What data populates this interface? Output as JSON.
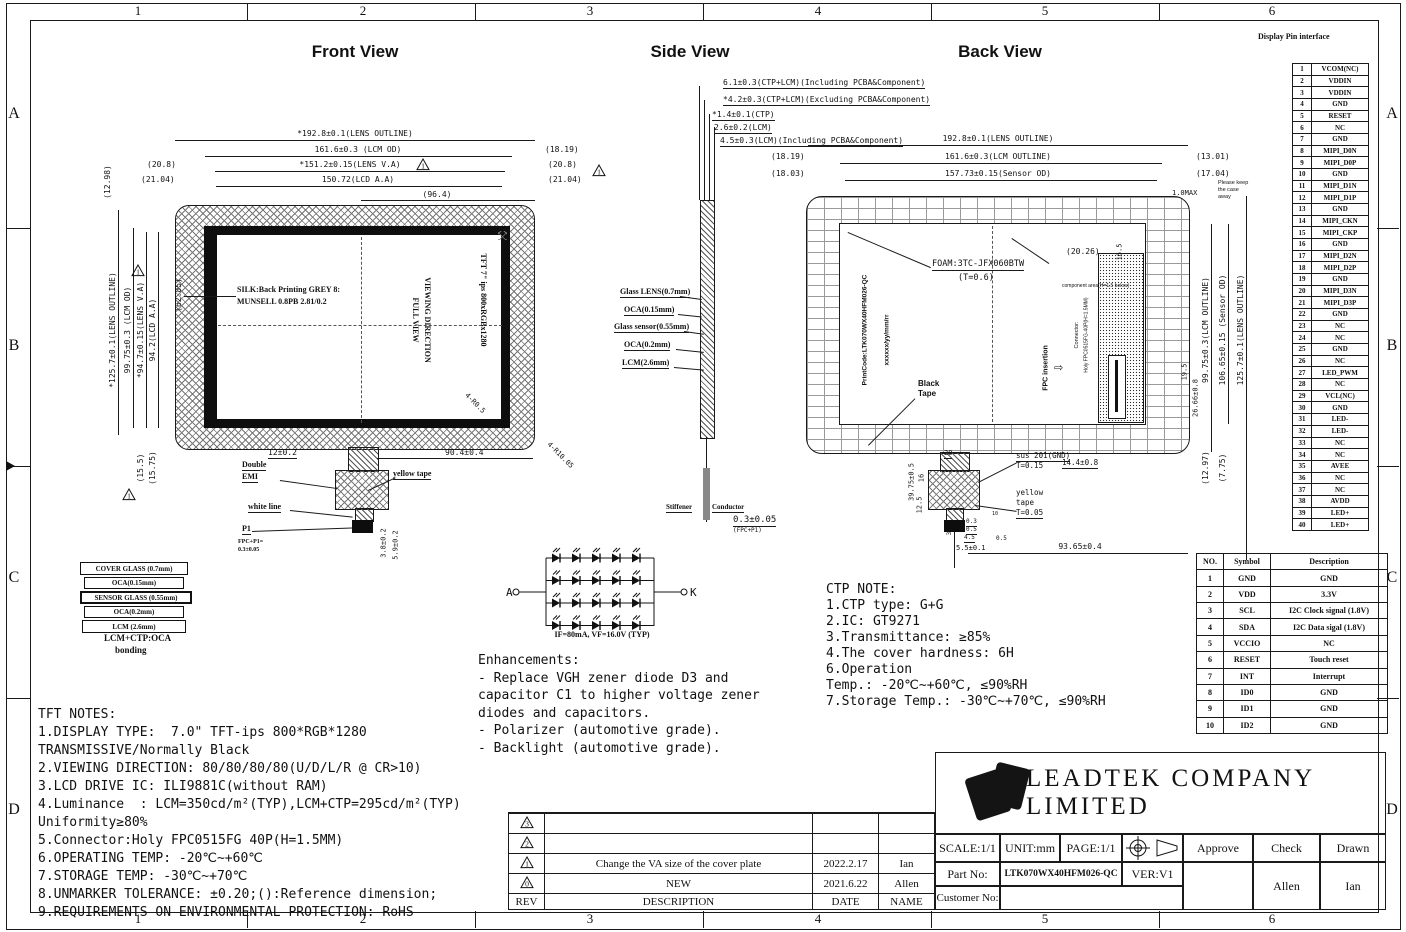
{
  "sheet": {
    "cols": [
      "1",
      "2",
      "3",
      "4",
      "5",
      "6"
    ],
    "rows": [
      "A",
      "B",
      "C",
      "D"
    ]
  },
  "front_view": {
    "title": "Front View",
    "dim_lens_outline_h": "*192.8±0.1(LENS OUTLINE)",
    "dim_lcm_od_h": "161.6±0.3 (LCM OD)",
    "dim_lens_va_h": "*151.2±0.15(LENS V.A)",
    "dim_lcd_aa_h": "150.72(LCD A.A)",
    "dim_96_4": "(96.4)",
    "dim_18_19_r": "(18.19)",
    "dim_20_8_l": "(20.8)",
    "dim_20_8_r": "(20.8)",
    "dim_21_04_l": "(21.04)",
    "dim_21_04_r": "(21.04)",
    "dim_12_98": "(12.98)",
    "dim_lens_outline_v": "*125.7±0.1(LENS OUTLINE)",
    "dim_lcm_od_v": "99.75±0.3 (LCM OD)",
    "dim_lens_va_v": "*94.7±0.15(LENS V.A)",
    "dim_lcd_aa_v": "94.2(LCD A.A)",
    "dim_62_85": "(62.85)",
    "dim_15_5": "(15.5)",
    "dim_15_75": "(15.75)",
    "silk_line1": "SILK:Back Printing GREY 8:",
    "silk_line2": "MUNSELL 0.8PB 2.81/0.2",
    "viewing_direction_1": "VIEWING DIRECTION",
    "viewing_direction_2": "FULL VIEW",
    "panel_label": "TFT 7\" ips 800xRGBx1280",
    "corner_r_inner": "4-R0.5",
    "corner_r_outer": "4-R10.05",
    "dim_12": "12±0.2",
    "dim_90_4": "90.4±0.4",
    "lbl_double": "Double",
    "lbl_emi": "EMI",
    "lbl_yellow_tape": "yellow tape",
    "lbl_white_line": "white line",
    "lbl_p1": "P1",
    "lbl_fpc_p1a": "FPC+P1=",
    "lbl_fpc_p1b": "0.3±0.05",
    "dim_3_8": "3.8±0.2",
    "dim_5_9": "5.9±0.2"
  },
  "stack": {
    "layers": [
      "COVER GLASS (0.7mm)",
      "OCA(0.15mm)",
      "SENSOR GLASS (0.55mm)",
      "OCA(0.2mm)",
      "LCM (2.6mm)"
    ],
    "caption1": "LCM+CTP:OCA",
    "caption2": "bonding"
  },
  "side_view": {
    "title": "Side View",
    "top_dims": [
      "6.1±0.3(CTP+LCM)(Including PCBA&Component)",
      "*4.2±0.3(CTP+LCM)(Excluding PCBA&Component)",
      "*1.4±0.1(CTP)",
      "2.6±0.2(LCM)",
      "4.5±0.3(LCM)(Including PCBA&Component)"
    ],
    "layer_labels": [
      "Glass LENS(0.7mm)",
      "OCA(0.15mm)",
      "Glass sensor(0.55mm)",
      "OCA(0.2mm)",
      "LCM(2.6mm)"
    ],
    "stiffener": "Stiffener",
    "conductor": "Conductor",
    "fpc_dim": "0.3±0.05",
    "fpc_dim2": "(FPC+P1)"
  },
  "led": {
    "anode": "A",
    "cathode": "K",
    "label": "IF=80mA, VF=16.0V (TYP)",
    "rows": 4,
    "diodes_per_row": 5
  },
  "back_view": {
    "title": "Back View",
    "dim_lens": "192.8±0.1(LENS OUTLINE)",
    "dim_18_19": "(18.19)",
    "dim_lcm": "161.6±0.3(LCM OUTLINE)",
    "dim_13_01": "(13.01)",
    "dim_18_03": "(18.03)",
    "dim_sensor": "157.73±0.15(Sensor OD)",
    "dim_17_04": "(17.04)",
    "dim_1max": "1.0MAX",
    "note_case1": "Please keep",
    "note_case2": "the case",
    "note_case3": "away",
    "dim_20_26": "(20.26)",
    "dim_16_5": "16.5",
    "foam1": "FOAM:3TC-JFX060BTW",
    "foam2": "(T=0.6)",
    "component_area": "component area(H=1.5 below)",
    "printcode": "PrintCode:LTK070WX40HFM026-QC",
    "datecode": "xxxxxx/yy/mm/rr",
    "black_tape1": "Black",
    "black_tape2": "Tape",
    "connector1": "Connector:",
    "connector2": "Holy FPC0515FG-40P(H=1.5MM)",
    "fpc_insertion": "FPC insertion",
    "dim_19_5": "19.5",
    "dim_26_66": "26.66±0.8",
    "dim_99_75": "99.75±0.3(LCM OUTLINE)",
    "dim_106_65": "106.65±0.15 (Sensor OD)",
    "dim_125_7": "125.7±0.1(LENS OUTLINE)",
    "dim_12_97": "(12.97)",
    "dim_7_75": "(7.75)",
    "dim_20": "20",
    "dim_39_75": "39.75±0.5",
    "dim_16": "16",
    "dim_12_5": "12.5",
    "sus": "sus 201(GND)",
    "sus_t": "T=0.15",
    "yellow1": "yellow",
    "yellow2": "tape",
    "yellow_t": "T=0.05",
    "dim_14_4": "14.4±0.8",
    "dim_0_3": "0.3",
    "dim_0_5a": "0.5",
    "dim_4_5": "4.5",
    "dim_0_5b": "0.5",
    "dim_3_5": "3.5",
    "dim_5_5": "5.5±0.1",
    "dim_10": "10",
    "dim_93_65": "93.65±0.4"
  },
  "ctp_note": {
    "lines": [
      "CTP NOTE:",
      "1.CTP type: G+G",
      "2.IC: GT9271",
      "3.Transmittance: ≥85%",
      "4.The cover hardness: 6H",
      "6.Operation",
      "Temp.: -20℃~+60℃, ≤90%RH",
      "7.Storage Temp.: -30℃~+70℃, ≤90%RH"
    ]
  },
  "enhancements": {
    "lines": [
      "Enhancements:",
      "- Replace VGH zener diode D3 and",
      "capacitor C1 to higher voltage zener",
      "diodes and capacitors.",
      "- Polarizer (automotive grade).",
      "- Backlight (automotive grade)."
    ]
  },
  "tft_notes": {
    "lines": [
      "TFT NOTES:",
      "1.DISPLAY TYPE:  7.0\" TFT-ips 800*RGB*1280",
      "TRANSMISSIVE/Normally Black",
      "2.VIEWING DIRECTION: 80/80/80/80(U/D/L/R @ CR>10)",
      "3.LCD DRIVE IC: ILI9881C(without RAM)",
      "4.Luminance  : LCM=350cd/m²(TYP),LCM+CTP=295cd/m²(TYP)",
      "Uniformity≥80%",
      "5.Connector:Holy FPC0515FG 40P(H=1.5MM)",
      "6.OPERATING TEMP: -20℃~+60℃",
      "7.STORAGE TEMP: -30℃~+70℃",
      "8.UNMARKER TOLERANCE: ±0.20;():Reference dimension;",
      "9.REQUIREMENTS ON ENVIRONMENTAL PROTECTION: RoHS"
    ]
  },
  "pin_interface": {
    "title": "Display Pin interface",
    "pins": [
      [
        "1",
        "VCOM(NC)"
      ],
      [
        "2",
        "VDDIN"
      ],
      [
        "3",
        "VDDIN"
      ],
      [
        "4",
        "GND"
      ],
      [
        "5",
        "RESET"
      ],
      [
        "6",
        "NC"
      ],
      [
        "7",
        "GND"
      ],
      [
        "8",
        "MIPI_D0N"
      ],
      [
        "9",
        "MIPI_D0P"
      ],
      [
        "10",
        "GND"
      ],
      [
        "11",
        "MIPI_D1N"
      ],
      [
        "12",
        "MIPI_D1P"
      ],
      [
        "13",
        "GND"
      ],
      [
        "14",
        "MIPI_CKN"
      ],
      [
        "15",
        "MIPI_CKP"
      ],
      [
        "16",
        "GND"
      ],
      [
        "17",
        "MIPI_D2N"
      ],
      [
        "18",
        "MIPI_D2P"
      ],
      [
        "19",
        "GND"
      ],
      [
        "20",
        "MIPI_D3N"
      ],
      [
        "21",
        "MIPI_D3P"
      ],
      [
        "22",
        "GND"
      ],
      [
        "23",
        "NC"
      ],
      [
        "24",
        "NC"
      ],
      [
        "25",
        "GND"
      ],
      [
        "26",
        "NC"
      ],
      [
        "27",
        "LED_PWM"
      ],
      [
        "28",
        "NC"
      ],
      [
        "29",
        "VCL(NC)"
      ],
      [
        "30",
        "GND"
      ],
      [
        "31",
        "LED-"
      ],
      [
        "32",
        "LED-"
      ],
      [
        "33",
        "NC"
      ],
      [
        "34",
        "NC"
      ],
      [
        "35",
        "AVEE"
      ],
      [
        "36",
        "NC"
      ],
      [
        "37",
        "NC"
      ],
      [
        "38",
        "AVDD"
      ],
      [
        "39",
        "LED+"
      ],
      [
        "40",
        "LED+"
      ]
    ]
  },
  "touch_table": {
    "headers": [
      "NO.",
      "Symbol",
      "Description"
    ],
    "rows": [
      [
        "1",
        "GND",
        "GND"
      ],
      [
        "2",
        "VDD",
        "3.3V"
      ],
      [
        "3",
        "SCL",
        "I2C Clock signal (1.8V)"
      ],
      [
        "4",
        "SDA",
        "I2C Data sigal (1.8V)"
      ],
      [
        "5",
        "VCCIO",
        "NC"
      ],
      [
        "6",
        "RESET",
        "Touch reset"
      ],
      [
        "7",
        "INT",
        "Interrupt"
      ],
      [
        "8",
        "ID0",
        "GND"
      ],
      [
        "9",
        "ID1",
        "GND"
      ],
      [
        "10",
        "ID2",
        "GND"
      ]
    ]
  },
  "revision": {
    "headers": [
      "REV",
      "DESCRIPTION",
      "DATE",
      "NAME"
    ],
    "rows": [
      {
        "rev": "",
        "desc": "",
        "date": "",
        "name": ""
      },
      {
        "rev": "3",
        "desc": "",
        "date": "",
        "name": ""
      },
      {
        "rev": "2",
        "desc": "",
        "date": "",
        "name": ""
      },
      {
        "rev": "1",
        "desc": "Change the VA size of the cover plate",
        "date": "2022.2.17",
        "name": "Ian"
      },
      {
        "rev": "0",
        "desc": "NEW",
        "date": "2021.6.22",
        "name": "Allen"
      }
    ]
  },
  "title_block": {
    "company": "LEADTEK COMPANY LIMITED",
    "scale": "SCALE:1/1",
    "unit": "UNIT:mm",
    "page": "PAGE:1/1",
    "approve": "Approve",
    "check": "Check",
    "drawn": "Drawn",
    "part_no_label": "Part No:",
    "part_no": "LTK070WX40HFM026-QC",
    "ver": "VER:V1",
    "customer_label": "Customer No:",
    "check_name": "Allen",
    "drawn_name": "Ian"
  }
}
